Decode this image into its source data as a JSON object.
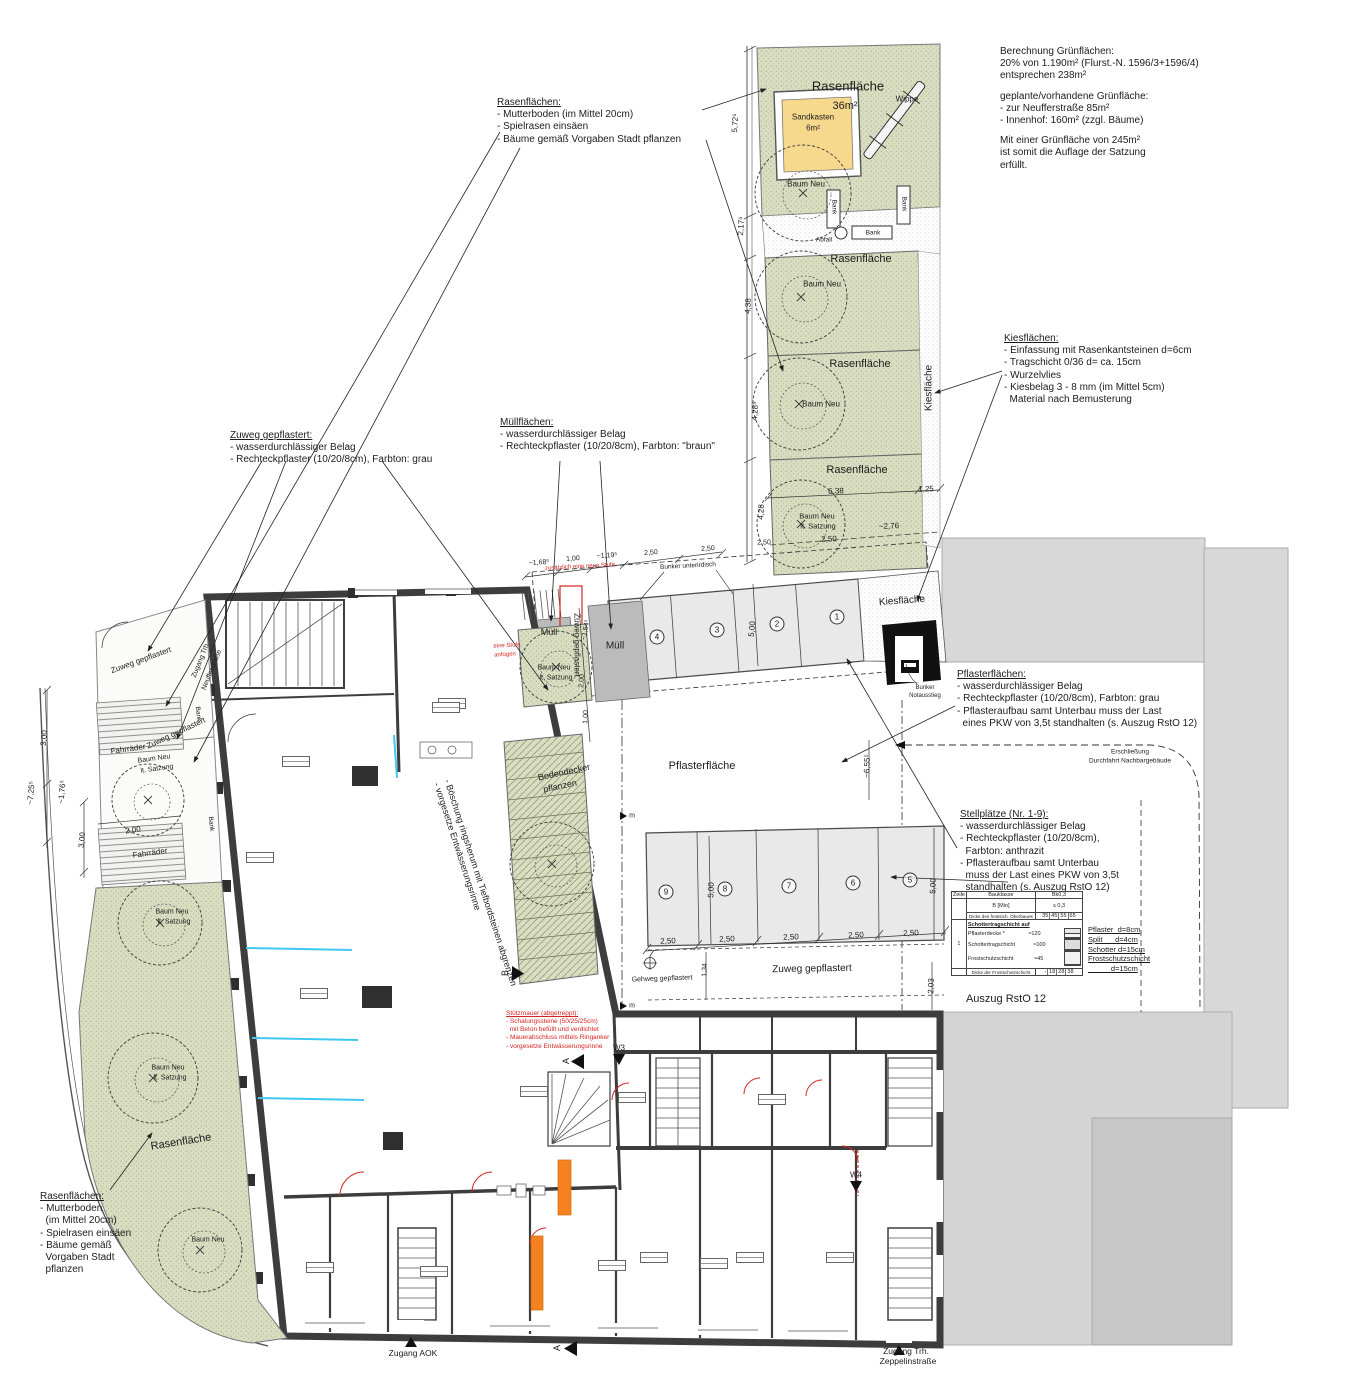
{
  "annotations": {
    "berechnung": {
      "title": null,
      "lines": [
        "Berechnung Grünflächen:",
        "20% von 1.190m² (Flurst.-N. 1596/3+1596/4)",
        "entsprechen 238m²",
        "",
        "geplante/vorhandene Grünfläche:",
        "- zur Neufferstraße 85m²",
        "- Innenhof: 160m² (zzgl. Bäume)",
        "",
        "Mit einer Grünfläche von 245m²",
        "ist somit die Auflage der Satzung",
        "erfüllt."
      ]
    },
    "rasen_top": {
      "title": "Rasenflächen:",
      "lines": [
        "- Mutterboden (im Mittel 20cm)",
        "- Spielrasen einsäen",
        "- Bäume gemäß Vorgaben Stadt pflanzen"
      ]
    },
    "zuweg": {
      "title": "Zuweg gepflastert:",
      "lines": [
        "- wasserdurchlässiger Belag",
        "- Rechteckpflaster (10/20/8cm), Farbton: grau"
      ]
    },
    "muell": {
      "title": "Müllflächen:",
      "lines": [
        "- wasserdurchlässiger Belag",
        "- Rechteckpflaster (10/20/8cm), Farbton: \"braun\""
      ]
    },
    "kies": {
      "title": "Kiesflächen:",
      "lines": [
        "- Einfassung mit Rasenkantsteinen d=6cm",
        "- Tragschicht 0/36 d= ca. 15cm",
        "- Wurzelvlies",
        "- Kiesbelag 3 - 8 mm (im Mittel 5cm)",
        "  Material nach Bemusterung"
      ]
    },
    "pflaster": {
      "title": "Pflasterflächen:",
      "lines": [
        "- wasserdurchlässiger Belag",
        "- Rechteckpflaster (10/20/8cm), Farbton: grau",
        "- Pflasteraufbau samt Unterbau muss der Last",
        "  eines PKW von 3,5t standhalten (s. Auszug RstO 12)"
      ]
    },
    "stellplaetze": {
      "title": "Stellplätze (Nr. 1-9):",
      "lines": [
        "- wasserdurchlässiger Belag",
        "- Rechteckpflaster (10/20/8cm),",
        "  Farbton: anthrazit",
        "- Pflasteraufbau samt Unterbau",
        "  muss der Last eines PKW von 3,5t",
        "  standhalten (s. Auszug RstO 12)"
      ]
    },
    "rasen_bottom": {
      "title": "Rasenflächen:",
      "lines": [
        "- Mutterboden",
        "  (im Mittel 20cm)",
        "- Spielrasen einsäen",
        "- Bäume gemäß",
        "  Vorgaben Stadt",
        "  pflanzen"
      ]
    },
    "stuetzmauer": {
      "title": "Stützmauer (abgetreppt):",
      "lines": [
        "- Schalungssteine (50/25/25cm)",
        "  mit Beton befüllt und verdichtet",
        "- Mauerabschluss mittels Ringanker",
        "- vorgesetze Entwässerungsrinne"
      ]
    },
    "boeschung": {
      "title": null,
      "lines": [
        "- Böschung ringsherum mit Tiefbordsteinen abgrenzen",
        "- vorgesetze Entwässerungsrinne"
      ]
    },
    "rsto_legend": {
      "title": null,
      "lines": [
        "Pflaster  d=8cm",
        "Split      d=4cm",
        "Schotter d=15cm",
        "Frostschutzschicht",
        "           d=15cm"
      ]
    }
  },
  "rsto": {
    "h_zeile": "Zeile",
    "h_bauklasse": "Bauklasse",
    "h_bk": "Bk0,3",
    "r1_label": "B [Mio]",
    "r1_val": "≤ 0,3",
    "r2_label": "Dicke des frostsich. Oberbaues",
    "r2_vals": [
      "35",
      "45",
      "55",
      "65"
    ],
    "zeile": "1",
    "body_title": "Schottertragschicht auf",
    "layer1": "Pflasterdecke *",
    "layer2": "Schottertragschicht",
    "layer3": "Frostschutzschicht",
    "d1": "≈120",
    "d2": "≈100",
    "d3": "≈45",
    "r3_label": "Dicke der Frostschutzschicht",
    "r3_vals": [
      "-",
      "18",
      "28",
      "38"
    ]
  },
  "plan_labels": [
    {
      "t": "Rasenfläche",
      "x": 848,
      "y": 86,
      "r": 0,
      "s": 13
    },
    {
      "t": "36m²",
      "x": 845,
      "y": 106,
      "r": 0,
      "s": 11
    },
    {
      "t": "Sandkasten",
      "x": 813,
      "y": 117,
      "r": 0,
      "s": 8
    },
    {
      "t": "6m²",
      "x": 813,
      "y": 128,
      "r": 0,
      "s": 8
    },
    {
      "t": "Wippe",
      "x": 907,
      "y": 99,
      "r": 0,
      "s": 8
    },
    {
      "t": "Baum Neu",
      "x": 806,
      "y": 184,
      "r": 0,
      "s": 8
    },
    {
      "t": "Bank",
      "x": 834,
      "y": 207,
      "r": 90,
      "s": 6.5
    },
    {
      "t": "Bank",
      "x": 904,
      "y": 204,
      "r": 90,
      "s": 6.5
    },
    {
      "t": "Bank",
      "x": 873,
      "y": 233,
      "r": 0,
      "s": 6.5
    },
    {
      "t": "Abfall",
      "x": 824,
      "y": 240,
      "r": 0,
      "s": 6.5
    },
    {
      "t": "Rasenfläche",
      "x": 861,
      "y": 259,
      "r": 0,
      "s": 11
    },
    {
      "t": "Baum Neu",
      "x": 822,
      "y": 284,
      "r": 0,
      "s": 8
    },
    {
      "t": "Rasenfläche",
      "x": 860,
      "y": 364,
      "r": 0,
      "s": 11
    },
    {
      "t": "Baum Neu",
      "x": 821,
      "y": 404,
      "r": 0,
      "s": 8
    },
    {
      "t": "Rasenfläche",
      "x": 857,
      "y": 470,
      "r": 0,
      "s": 11
    },
    {
      "t": "Baum Neu",
      "x": 817,
      "y": 516,
      "r": 0,
      "s": 7.5
    },
    {
      "t": "lt. Satzung",
      "x": 818,
      "y": 526,
      "r": 0,
      "s": 7.5
    },
    {
      "t": "Kiesfläche",
      "x": 929,
      "y": 388,
      "r": -90,
      "s": 10
    },
    {
      "t": "Kiesfläche",
      "x": 902,
      "y": 601,
      "r": -4,
      "s": 10
    },
    {
      "t": "Müll",
      "x": 549,
      "y": 632,
      "r": 0,
      "s": 9
    },
    {
      "t": "Müll",
      "x": 615,
      "y": 646,
      "r": 0,
      "s": 10
    },
    {
      "t": "Bunker unterirdisch",
      "x": 688,
      "y": 566,
      "r": -3,
      "s": 6.5
    },
    {
      "t": "4",
      "x": 657,
      "y": 637,
      "r": 0,
      "s": 8,
      "k": "circ"
    },
    {
      "t": "3",
      "x": 717,
      "y": 630,
      "r": 0,
      "s": 8,
      "k": "circ"
    },
    {
      "t": "2",
      "x": 777,
      "y": 624,
      "r": 0,
      "s": 8,
      "k": "circ"
    },
    {
      "t": "1",
      "x": 837,
      "y": 617,
      "r": 0,
      "s": 8,
      "k": "circ"
    },
    {
      "t": "Bunker",
      "x": 925,
      "y": 688,
      "r": 0,
      "s": 6
    },
    {
      "t": "Notausstieg",
      "x": 925,
      "y": 696,
      "r": 0,
      "s": 6
    },
    {
      "t": "Pflasterfläche",
      "x": 702,
      "y": 766,
      "r": 0,
      "s": 11
    },
    {
      "t": "9",
      "x": 666,
      "y": 892,
      "r": 0,
      "s": 8,
      "k": "circ"
    },
    {
      "t": "8",
      "x": 725,
      "y": 889,
      "r": 0,
      "s": 8,
      "k": "circ"
    },
    {
      "t": "7",
      "x": 789,
      "y": 886,
      "r": 0,
      "s": 8,
      "k": "circ"
    },
    {
      "t": "6",
      "x": 853,
      "y": 883,
      "r": 0,
      "s": 8,
      "k": "circ"
    },
    {
      "t": "5",
      "x": 910,
      "y": 880,
      "r": 0,
      "s": 8,
      "k": "circ"
    },
    {
      "t": "2,50",
      "x": 668,
      "y": 941,
      "r": -2,
      "s": 8
    },
    {
      "t": "2,50",
      "x": 727,
      "y": 939,
      "r": -2,
      "s": 8
    },
    {
      "t": "2,50",
      "x": 791,
      "y": 937,
      "r": -2,
      "s": 8
    },
    {
      "t": "2,50",
      "x": 856,
      "y": 935,
      "r": -2,
      "s": 8
    },
    {
      "t": "2,50",
      "x": 911,
      "y": 933,
      "r": -2,
      "s": 8
    },
    {
      "t": "5,00",
      "x": 711,
      "y": 890,
      "r": -88,
      "s": 8
    },
    {
      "t": "5,00",
      "x": 933,
      "y": 886,
      "r": -88,
      "s": 8
    },
    {
      "t": "5,00",
      "x": 752,
      "y": 629,
      "r": -85,
      "s": 8
    },
    {
      "t": "Zuweg gepflastert",
      "x": 812,
      "y": 969,
      "r": -1,
      "s": 10
    },
    {
      "t": "Gehweg gepflastert",
      "x": 662,
      "y": 979,
      "r": -2,
      "s": 7
    },
    {
      "t": "1,34",
      "x": 705,
      "y": 970,
      "r": -88,
      "s": 7
    },
    {
      "t": "2,03",
      "x": 931,
      "y": 986,
      "r": -88,
      "s": 8
    },
    {
      "t": "Zuweg gepflastert",
      "x": 577,
      "y": 645,
      "r": 90,
      "s": 8
    },
    {
      "t": "Zuweg gepflastert",
      "x": 141,
      "y": 660,
      "r": -20,
      "s": 8
    },
    {
      "t": "Zuweg gepflastert",
      "x": 176,
      "y": 733,
      "r": -25,
      "s": 8
    },
    {
      "t": "Zugang Trh.",
      "x": 201,
      "y": 660,
      "r": -68,
      "s": 7
    },
    {
      "t": "Neufferstraße",
      "x": 212,
      "y": 670,
      "r": -68,
      "s": 7
    },
    {
      "t": "Fahrräder",
      "x": 128,
      "y": 749,
      "r": -8,
      "s": 8
    },
    {
      "t": "Fahrräder",
      "x": 150,
      "y": 853,
      "r": -8,
      "s": 8
    },
    {
      "t": "2,00",
      "x": 133,
      "y": 830,
      "r": -8,
      "s": 8
    },
    {
      "t": "Bank",
      "x": 198,
      "y": 714,
      "r": 84,
      "s": 6.5
    },
    {
      "t": "Bank",
      "x": 211,
      "y": 824,
      "r": 84,
      "s": 6.5
    },
    {
      "t": "Baum Neu",
      "x": 154,
      "y": 759,
      "r": -8,
      "s": 7
    },
    {
      "t": "lt. Satzung",
      "x": 157,
      "y": 769,
      "r": -8,
      "s": 7
    },
    {
      "t": "3,00",
      "x": 44,
      "y": 738,
      "r": -85,
      "s": 8
    },
    {
      "t": "~7,25⁵",
      "x": 31,
      "y": 793,
      "r": -85,
      "s": 8
    },
    {
      "t": "~1,76⁵",
      "x": 62,
      "y": 792,
      "r": -85,
      "s": 8
    },
    {
      "t": "3,00",
      "x": 82,
      "y": 840,
      "r": -85,
      "s": 8
    },
    {
      "t": "Baum Neu",
      "x": 172,
      "y": 912,
      "r": 0,
      "s": 7
    },
    {
      "t": "lt. Satzung",
      "x": 174,
      "y": 922,
      "r": 0,
      "s": 7
    },
    {
      "t": "Baum Neu",
      "x": 168,
      "y": 1068,
      "r": 0,
      "s": 7
    },
    {
      "t": "lt. Satzung",
      "x": 170,
      "y": 1078,
      "r": 0,
      "s": 7
    },
    {
      "t": "Baum Neu",
      "x": 208,
      "y": 1240,
      "r": 0,
      "s": 7
    },
    {
      "t": "Rasenfläche",
      "x": 181,
      "y": 1142,
      "r": -9,
      "s": 11
    },
    {
      "t": "Bodendecker",
      "x": 564,
      "y": 772,
      "r": -12,
      "s": 9
    },
    {
      "t": "pflanzen",
      "x": 560,
      "y": 786,
      "r": -12,
      "s": 9
    },
    {
      "t": "Baum Neu",
      "x": 554,
      "y": 668,
      "r": 0,
      "s": 7
    },
    {
      "t": "lt. Satzung",
      "x": 556,
      "y": 678,
      "r": 0,
      "s": 7
    },
    {
      "t": "~1,68⁵",
      "x": 539,
      "y": 563,
      "r": -4,
      "s": 7
    },
    {
      "t": "1,00",
      "x": 573,
      "y": 559,
      "r": -4,
      "s": 7
    },
    {
      "t": "~1,19⁵",
      "x": 607,
      "y": 556,
      "r": -4,
      "s": 7
    },
    {
      "t": "2,50",
      "x": 651,
      "y": 553,
      "r": -4,
      "s": 7
    },
    {
      "t": "2,50",
      "x": 708,
      "y": 549,
      "r": -4,
      "s": 7
    },
    {
      "t": "~1,54⁵",
      "x": 586,
      "y": 630,
      "r": -80,
      "s": 7
    },
    {
      "t": "2,00",
      "x": 582,
      "y": 681,
      "r": -88,
      "s": 7
    },
    {
      "t": "1,00",
      "x": 586,
      "y": 717,
      "r": -88,
      "s": 7
    },
    {
      "t": "5,72⁵",
      "x": 735,
      "y": 123,
      "r": -87,
      "s": 8
    },
    {
      "t": "2,17⁵",
      "x": 741,
      "y": 226,
      "r": -87,
      "s": 8
    },
    {
      "t": "4,38",
      "x": 748,
      "y": 306,
      "r": -87,
      "s": 8
    },
    {
      "t": "4,28⁵",
      "x": 755,
      "y": 411,
      "r": -87,
      "s": 8
    },
    {
      "t": "4,28",
      "x": 761,
      "y": 512,
      "r": -87,
      "s": 8
    },
    {
      "t": "6,38",
      "x": 836,
      "y": 491,
      "r": -2,
      "s": 8
    },
    {
      "t": "1,25",
      "x": 926,
      "y": 489,
      "r": -2,
      "s": 8
    },
    {
      "t": "2,50",
      "x": 829,
      "y": 539,
      "r": -2,
      "s": 8
    },
    {
      "t": "~2,76",
      "x": 889,
      "y": 526,
      "r": -2,
      "s": 8
    },
    {
      "t": "2,50",
      "x": 764,
      "y": 543,
      "r": -2,
      "s": 7
    },
    {
      "t": "~6,55⁵",
      "x": 867,
      "y": 766,
      "r": -88,
      "s": 8
    },
    {
      "t": "Erschließung",
      "x": 1130,
      "y": 752,
      "r": 0,
      "s": 6.5
    },
    {
      "t": "Durchfahrt Nachbargebäude",
      "x": 1130,
      "y": 761,
      "r": 0,
      "s": 6.5
    },
    {
      "t": "Zugang AOK",
      "x": 413,
      "y": 1353,
      "r": 0,
      "s": 8.5
    },
    {
      "t": "Zugang Trh.",
      "x": 906,
      "y": 1351,
      "r": 0,
      "s": 8.5
    },
    {
      "t": "Zeppelinstraße",
      "x": 908,
      "y": 1361,
      "r": 0,
      "s": 8.5
    },
    {
      "t": "W3",
      "x": 619,
      "y": 1048,
      "r": 0,
      "s": 8
    },
    {
      "t": "W4",
      "x": 856,
      "y": 1175,
      "r": 0,
      "s": 8
    },
    {
      "t": "A",
      "x": 566,
      "y": 1061,
      "r": -90,
      "s": 9
    },
    {
      "t": "A",
      "x": 557,
      "y": 1348,
      "r": -90,
      "s": 9
    },
    {
      "t": "B",
      "x": 505,
      "y": 973,
      "r": -90,
      "s": 9
    },
    {
      "t": "m",
      "x": 632,
      "y": 816,
      "r": 0,
      "s": 7
    },
    {
      "t": "m",
      "x": 632,
      "y": 1006,
      "r": 0,
      "s": 7
    },
    {
      "t": "zusätzlich eine neue Stufe",
      "x": 580,
      "y": 567,
      "r": -3,
      "s": 6,
      "c": "#d42420"
    },
    {
      "t": "eine Stufe",
      "x": 507,
      "y": 646,
      "r": -3,
      "s": 6,
      "c": "#d42420"
    },
    {
      "t": "anfügen",
      "x": 505,
      "y": 655,
      "r": -3,
      "s": 6,
      "c": "#d42420"
    },
    {
      "t": "Auszug RstO 12",
      "x": 1006,
      "y": 999,
      "r": 0,
      "s": 11
    }
  ],
  "stamps": [
    {
      "x": 282,
      "y": 756
    },
    {
      "x": 246,
      "y": 852
    },
    {
      "x": 300,
      "y": 988
    },
    {
      "x": 438,
      "y": 698
    },
    {
      "x": 520,
      "y": 1086
    },
    {
      "x": 618,
      "y": 1092
    },
    {
      "x": 758,
      "y": 1094
    },
    {
      "x": 640,
      "y": 1252
    },
    {
      "x": 736,
      "y": 1252
    },
    {
      "x": 826,
      "y": 1252
    },
    {
      "x": 306,
      "y": 1262
    },
    {
      "x": 420,
      "y": 1266
    },
    {
      "x": 598,
      "y": 1260
    },
    {
      "x": 700,
      "y": 1258
    },
    {
      "x": 432,
      "y": 702
    }
  ],
  "colors": {
    "lawn_green": "#d9ddc1",
    "sand_yellow": "#f6d98c",
    "stall_gray": "#e9e9e9",
    "muell_gray": "#bbbbbb",
    "neighbor_gray": "#d8d8d8",
    "wall_dark": "#3d3d3d",
    "accent_red": "#d42420",
    "accent_orange": "#f5821f",
    "accent_cyan": "#40c8f0"
  }
}
